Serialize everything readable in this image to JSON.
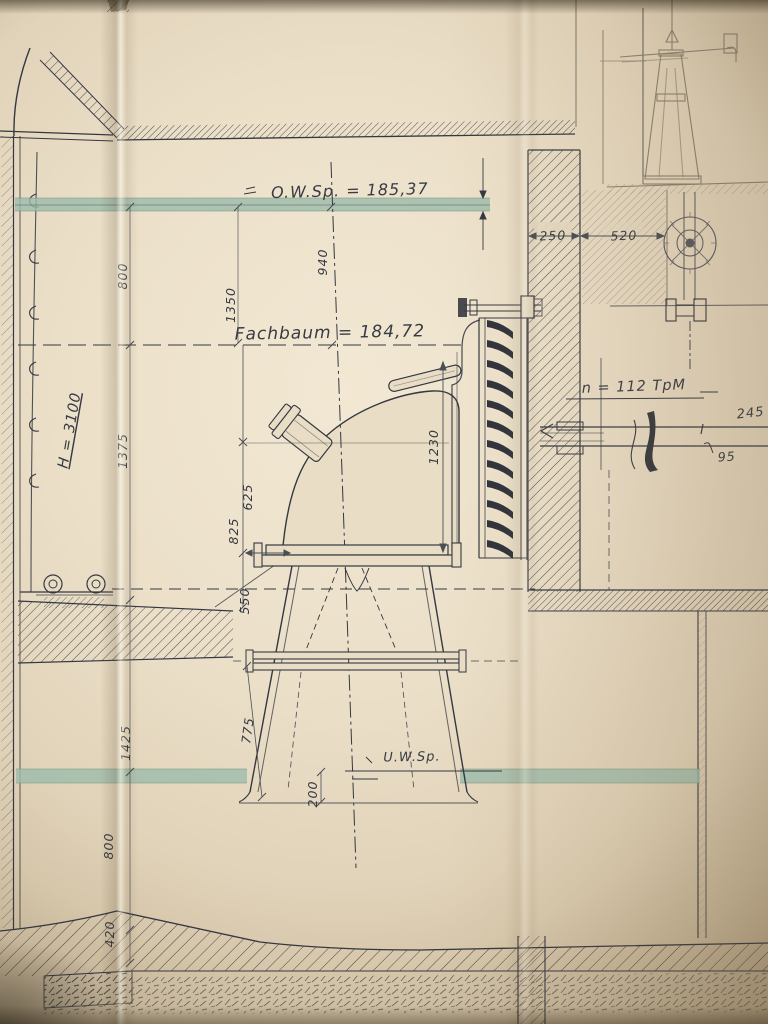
{
  "drawing": {
    "labels": {
      "headwater": "O.W.Sp. = 185,37",
      "fachbaum": "Fachbaum = 184,72",
      "tailwater": "U.W.Sp.",
      "rpm": "n = 112 TpM"
    },
    "dims": {
      "d250": "250",
      "d520": "520",
      "d940": "940",
      "d800a": "800",
      "d1350": "1350",
      "dH": "H = 3100",
      "d1375": "1375",
      "d625": "625",
      "d825": "825",
      "d550": "550",
      "d1230": "1230",
      "d245": "245",
      "d95": "95",
      "d775": "775",
      "d1425": "1425",
      "d800b": "800",
      "d200": "200",
      "d420": "420"
    },
    "colors": {
      "paper": "#e9ddc6",
      "ink": "#343841",
      "pencil": "#8a8173",
      "water": "#9cbcab"
    }
  }
}
